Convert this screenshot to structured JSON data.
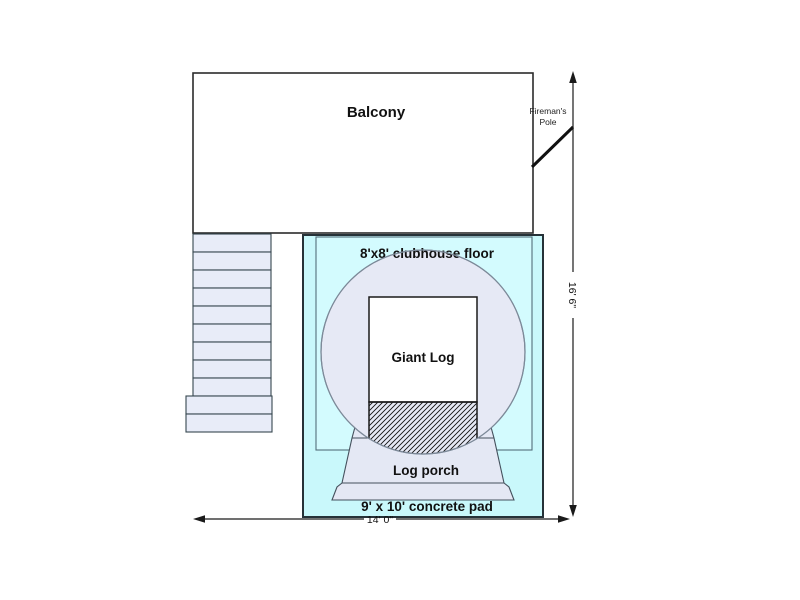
{
  "diagram": {
    "balcony": {
      "label": "Balcony"
    },
    "firemans_pole": {
      "label_line1": "Fireman's",
      "label_line2": "Pole"
    },
    "clubhouse_floor": {
      "label": "8'x8' clubhouse floor"
    },
    "giant_log": {
      "label": "Giant Log"
    },
    "log_porch": {
      "label": "Log porch"
    },
    "concrete_pad": {
      "label": "9' x 10' concrete pad"
    },
    "dimensions": {
      "overall_width": "14' 0\"",
      "overall_height": "16' 6\""
    }
  },
  "colors": {
    "balcony_fill": "#ffffff",
    "pad_fill": "#c9f8fb",
    "floor_fill": "#d3fbfe",
    "log_circle_fill": "#e6e9f5",
    "porch_fill": "#e4e8f4",
    "stair_fill": "#e8ecf8",
    "giant_log_fill": "#ffffff",
    "line_color": "#1a1a1a"
  }
}
